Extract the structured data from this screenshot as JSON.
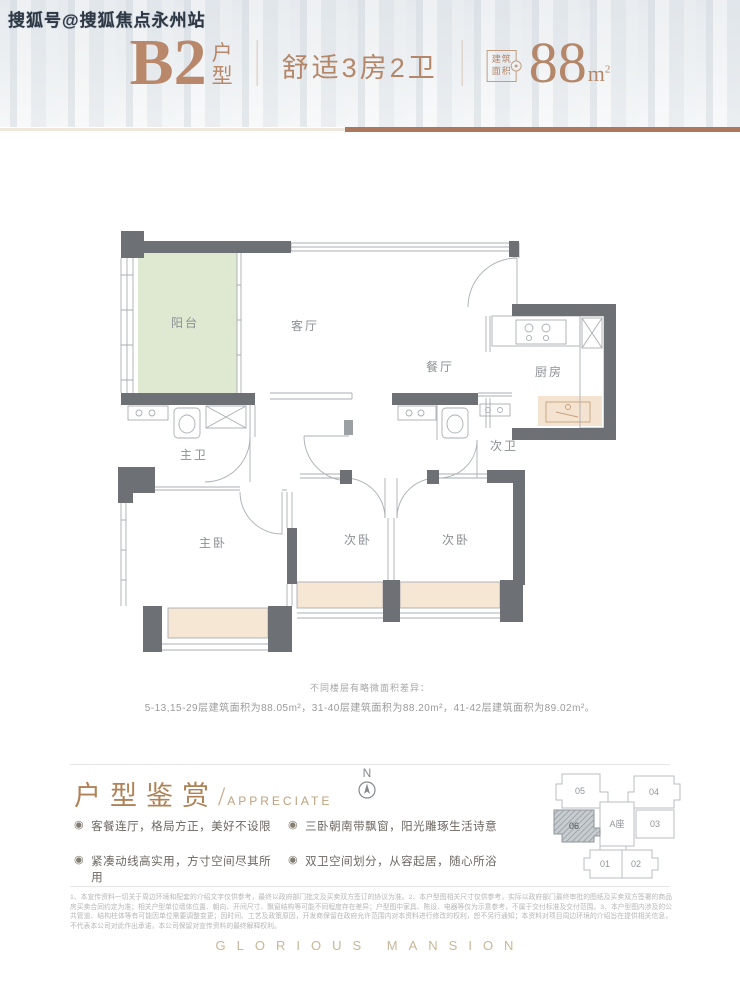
{
  "watermark": "搜狐号@搜狐焦点永州站",
  "colors": {
    "accent_copper": "#b5876a",
    "divider_brown": "#ac785d",
    "wall_gray": "#6d7175",
    "balcony_green": "#dfe9d2",
    "bay_peach": "#f6e6d4",
    "label_gray": "#8b9094",
    "footer_gold": "#c9b697"
  },
  "header": {
    "unit": "B2",
    "suffix_chars": [
      "户",
      "型"
    ],
    "subtitle": "舒适3房2卫",
    "badge_line1": "建筑",
    "badge_line2": "面积",
    "area_value": "88",
    "area_unit": "m",
    "area_sup": "2"
  },
  "floorplan": {
    "rooms": {
      "balcony": "阳台",
      "living": "客厅",
      "dining": "餐厅",
      "kitchen": "厨房",
      "master_bath": "主卫",
      "second_bath": "次卫",
      "master_bed": "主卧",
      "bed2": "次卧",
      "bed3": "次卧"
    },
    "note_line1": "不同楼层有略微面积差异：",
    "note_line2": "5-13,15-29层建筑面积为88.05m²，31-40层建筑面积为88.20m²，41-42层建筑面积为89.02m²。"
  },
  "appreciate": {
    "title": "户型鉴赏",
    "slash": "/",
    "title_en": "APPRECIATE",
    "bullet_icon": "◉",
    "bullets_left": [
      "客餐连厅，格局方正，美好不设限",
      "紧凑动线高实用，方寸空间尽其所用"
    ],
    "bullets_right": [
      "三卧朝南带飘窗，阳光雕琢生活诗意",
      "双卫空间划分，从容起居，随心所浴"
    ],
    "compass_label": "N"
  },
  "keyplan": {
    "u05": "05",
    "u04": "04",
    "u06": "06",
    "center": "A座",
    "u03": "03",
    "u01": "01",
    "u02": "02",
    "highlighted_unit": "06"
  },
  "disclaimer": "1、本宣传资料一切关于周边环境和配套的介绍文字仅供参考，最终以政府部门批文及买卖双方签订的协议为准。2、本户型图相关尺寸仅供参考，实际以政府部门最终审批的图纸及买卖双方签署的商品房买卖合同约定为准；相关户型单位墙体位置、朝向、开间尺寸、飘窗结构等可能不同程度存在差异；户型图中家具、陈设、电器等仅为示意参考，不属于交付标准及交付范围。3、本户型图内涉及的公共管道、结构柱体等有可能因单位需要调整变更；因时间、工艺及政策原因，开发商保留在政府允许范围内对本资料进行修改的权利，恕不另行通知；本资料对项目周边环境的介绍旨在提供相关信息，不代表本公司对此作出承诺，本公司保留对宣传资料的最终解释权利。",
  "footer_logo": "GLORIOUS MANSION"
}
